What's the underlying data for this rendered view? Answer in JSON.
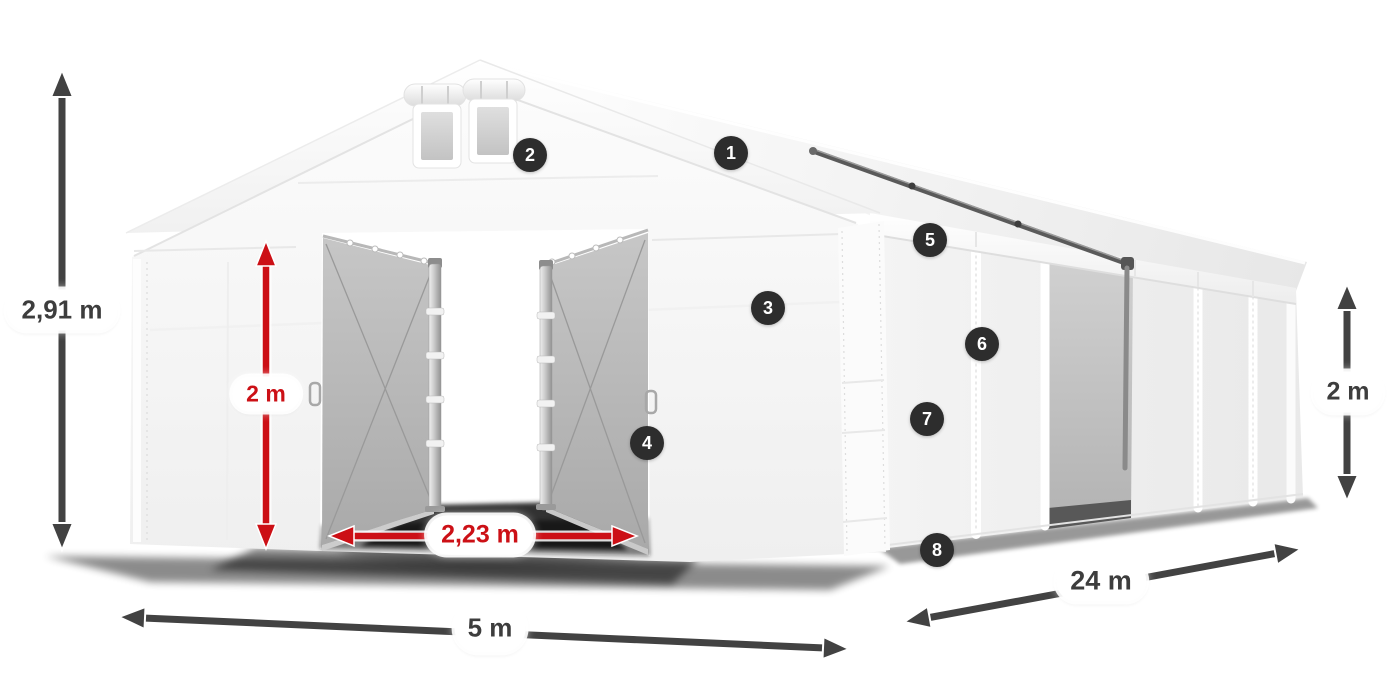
{
  "measurements": {
    "total_height": "2,91 m",
    "entrance_height": "2 m",
    "entrance_width": "2,23 m",
    "front_width": "5 m",
    "side_length": "24 m",
    "side_wall_height": "2 m"
  },
  "part_markers": [
    "1",
    "2",
    "3",
    "4",
    "5",
    "6",
    "7",
    "8"
  ],
  "colors": {
    "dimension_dark": "#424242",
    "dimension_red": "#cc1016",
    "label_text_dark": "#3d3d3d",
    "label_text_red": "#cc1016",
    "marker_background": "#2d2d2d",
    "marker_text": "#ffffff",
    "tent_white": "#f7f7f7",
    "interior_gray": "#b5b5b5"
  }
}
